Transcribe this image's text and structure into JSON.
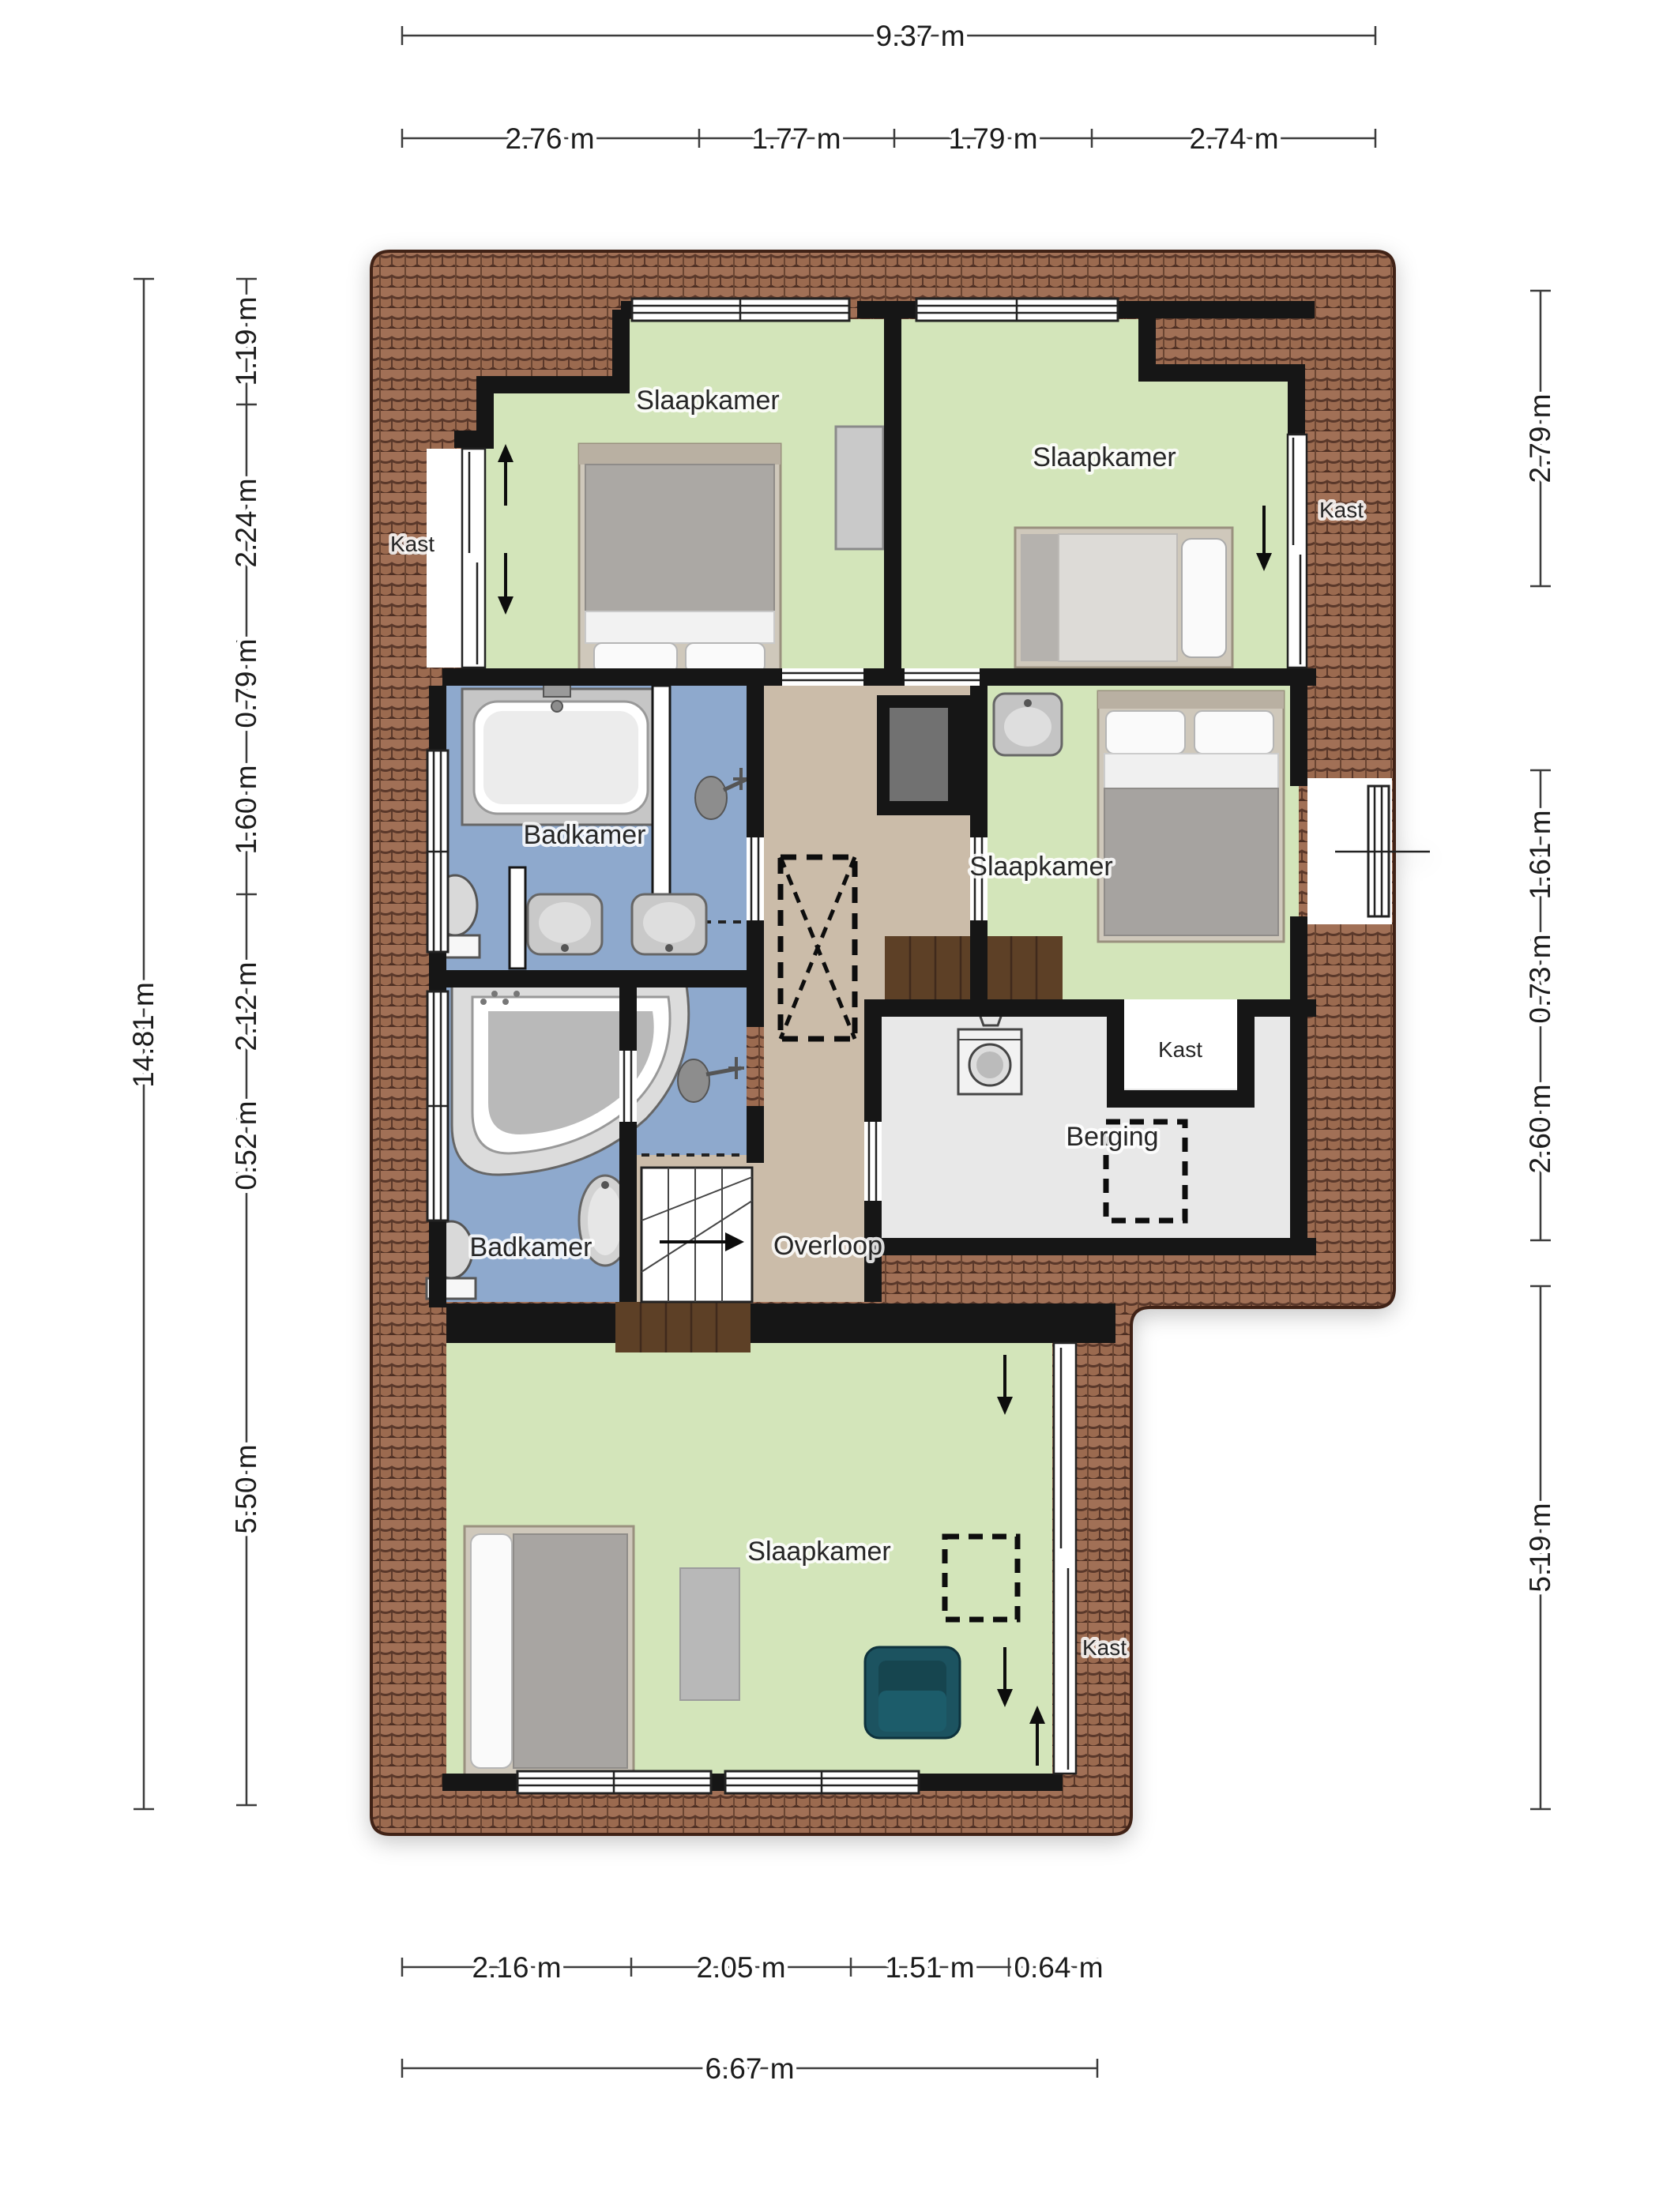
{
  "plan": {
    "rooms": {
      "bedroom_top_left": "Slaapkamer",
      "bedroom_top_right": "Slaapkamer",
      "bedroom_right": "Slaapkamer",
      "bedroom_bottom": "Slaapkamer",
      "bathroom_top": "Badkamer",
      "bathroom_bottom": "Badkamer",
      "landing": "Overloop",
      "storage": "Berging",
      "closet_top_left": "Kast",
      "closet_top_right": "Kast",
      "closet_middle": "Kast",
      "closet_bottom": "Kast"
    },
    "dimensions": {
      "top_total": "9.37 m",
      "top_segments": [
        "2.76 m",
        "1.77 m",
        "1.79 m",
        "2.74 m"
      ],
      "left_total": "14.81 m",
      "left_segments": [
        "1.19 m",
        "2.24 m",
        "0.79 m",
        "1.60 m",
        "2.12 m",
        "0.52 m",
        "5.50 m"
      ],
      "right_segments": [
        "2.79 m",
        "1.61 m",
        "0.73 m",
        "2.60 m",
        "5.19 m"
      ],
      "bottom_segments": [
        "2.16 m",
        "2.05 m",
        "1.51 m",
        "0.64 m"
      ],
      "bottom_total": "6.67 m"
    },
    "colors": {
      "room_green": "#d3e5ba",
      "bathroom_blue": "#8ea9cd",
      "landing_beige": "#cbbca9",
      "storage_gray": "#e8e8e8",
      "roof_brown": "#9b6a50",
      "wall_black": "#161616",
      "wood_brown": "#5d4128",
      "armchair_teal": "#1d5260"
    }
  }
}
